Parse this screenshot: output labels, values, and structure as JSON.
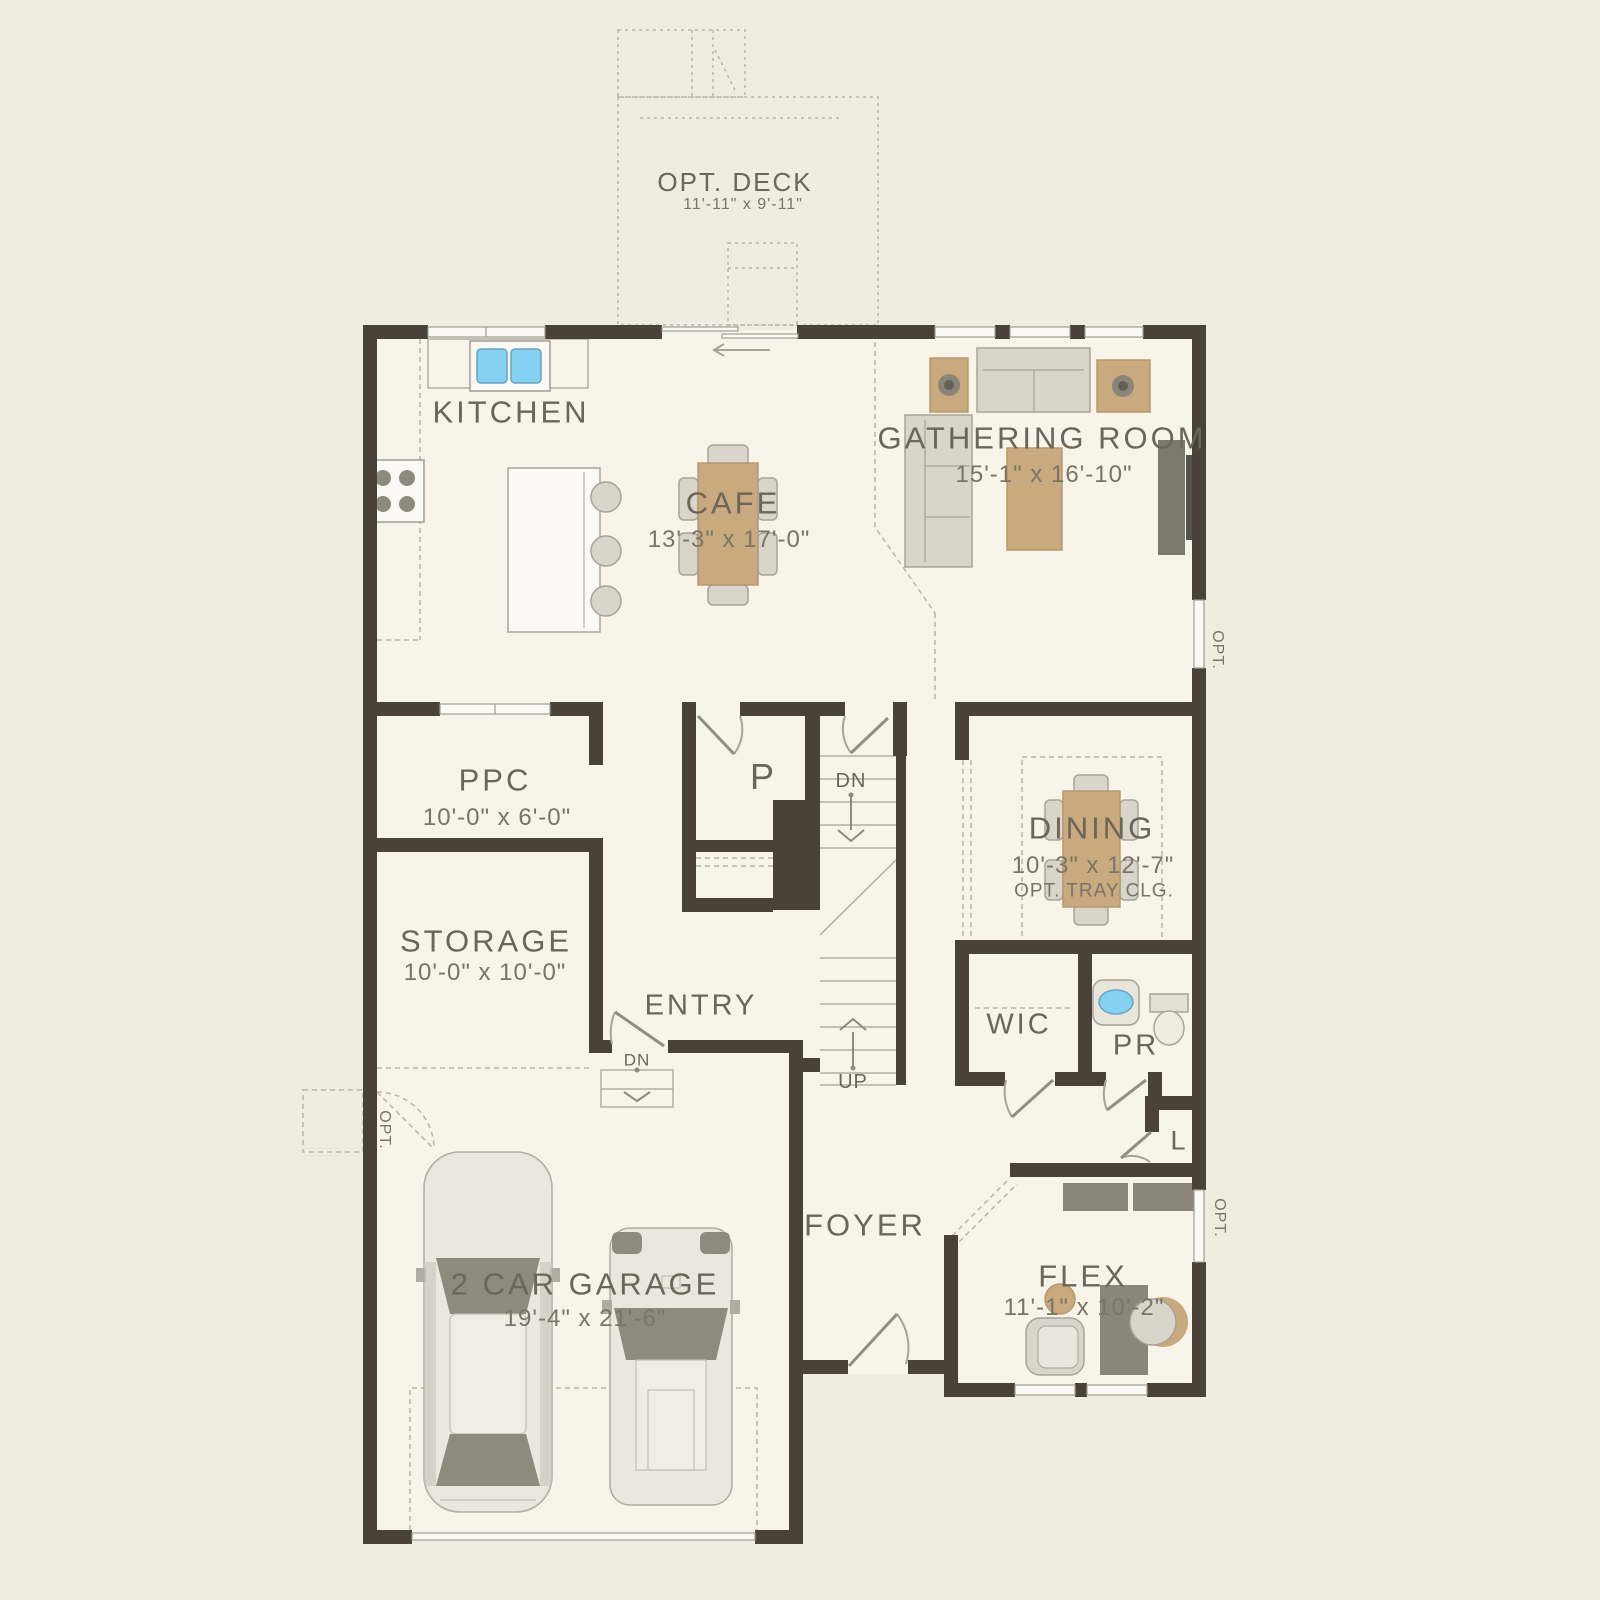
{
  "deck": {
    "label": "OPT. DECK",
    "dims": "11'-11\" x 9'-11\""
  },
  "rooms": {
    "kitchen": {
      "label": "KITCHEN"
    },
    "cafe": {
      "label": "CAFE",
      "dims": "13'-3\" x 17'-0\""
    },
    "gathering_room": {
      "label": "GATHERING ROOM",
      "dims": "15'-1\" x 16'-10\""
    },
    "ppc": {
      "label": "PPC",
      "dims": "10'-0\" x 6'-0\""
    },
    "storage": {
      "label": "STORAGE",
      "dims": "10'-0\" x 10'-0\""
    },
    "dining": {
      "label": "DINING",
      "dims": "10'-3\" x 12'-7\"",
      "note": "OPT. TRAY CLG."
    },
    "entry": {
      "label": "ENTRY"
    },
    "pantry": {
      "label": "P"
    },
    "wic": {
      "label": "WIC"
    },
    "powder_room": {
      "label": "PR"
    },
    "linen": {
      "label": "L"
    },
    "foyer": {
      "label": "FOYER"
    },
    "flex": {
      "label": "FLEX",
      "dims": "11'-1\" x 10'-2\""
    },
    "garage": {
      "label": "2 CAR GARAGE",
      "dims": "19'-4\" x 21'-6\""
    }
  },
  "stairs": {
    "down": "DN",
    "up": "UP"
  },
  "entry_steps": {
    "down": "DN"
  },
  "optional": {
    "gathering_window": "OPT.",
    "flex_window": "OPT.",
    "storage_door": "OPT."
  },
  "colors": {
    "background": "#f1ece0",
    "floor": "#f8f4ea",
    "wall": "#4a4238",
    "line": "#b3aea2",
    "text": "#6b655a",
    "tan_furniture": "#c9a97e",
    "gray_furniture": "#d9d5ca",
    "dark_furniture": "#8b857a",
    "sink_blue": "#85d1f2"
  }
}
